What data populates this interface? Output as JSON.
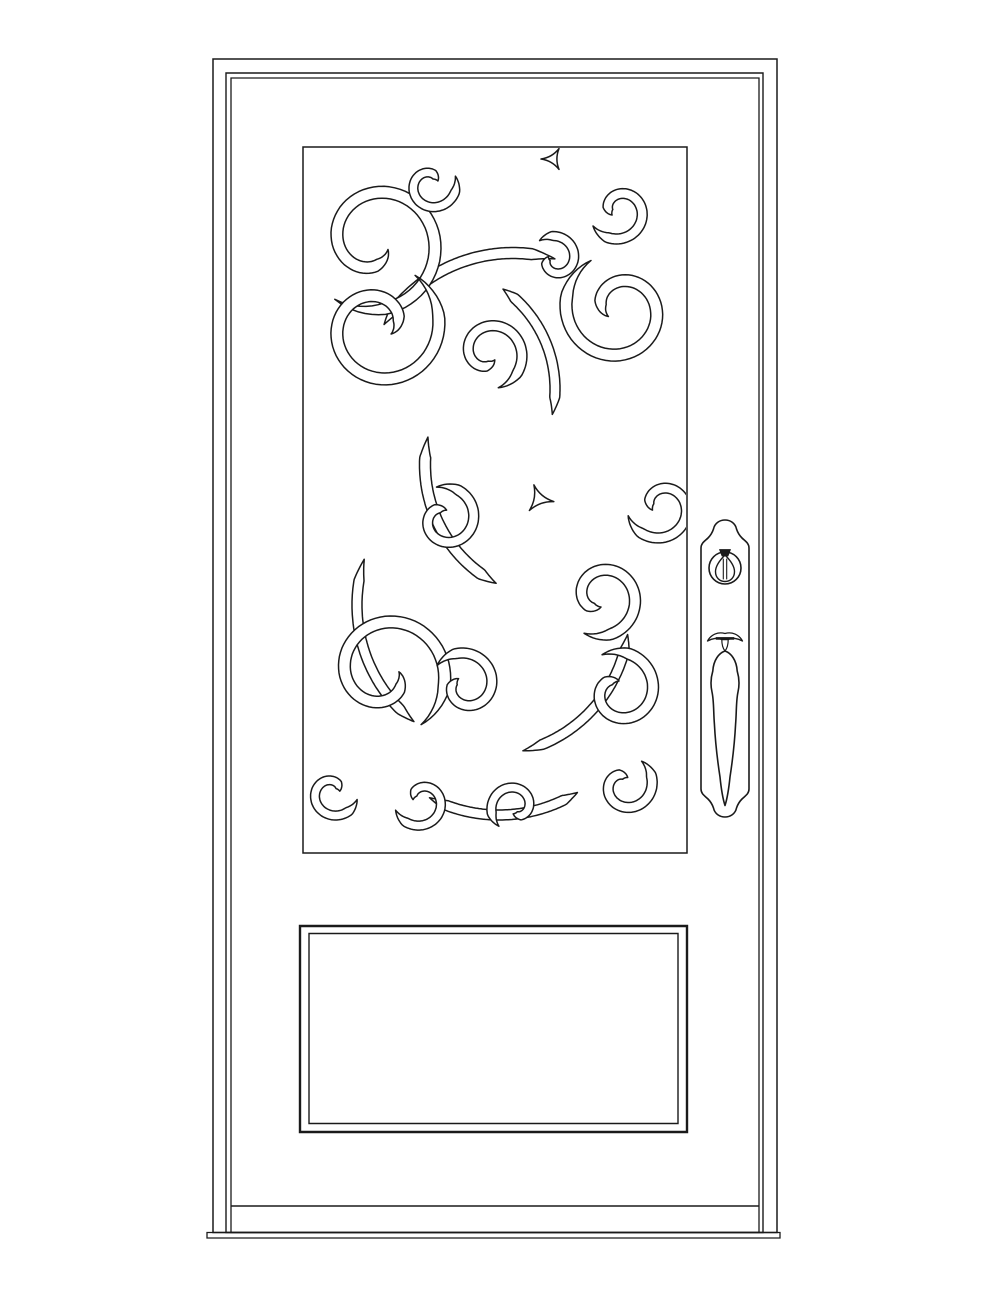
{
  "document": {
    "type": "door-elevation-line-drawing",
    "background_color": "#ffffff",
    "line_color": "#1a1a1a",
    "canvas": {
      "width": 1000,
      "height": 1294
    }
  },
  "frame": {
    "outer": {
      "name": "frame-outer-edge",
      "x": 213,
      "y": 59,
      "w": 564,
      "h": 1173.5,
      "sw": 1.5
    },
    "slab_outer": {
      "name": "door-slab-outer-edge",
      "x": 226,
      "y": 73,
      "w": 537,
      "h": 1159.5,
      "sw": 1.4
    },
    "slab_inner": {
      "name": "door-slab-inner-edge",
      "x": 231,
      "y": 78,
      "w": 528,
      "h": 1154.5,
      "sw": 1.3
    },
    "bottom_rail": {
      "name": "bottom-rail-line",
      "x1": 231,
      "y1": 1206,
      "x2": 759,
      "y2": 1206,
      "sw": 1.6
    },
    "sill": {
      "name": "threshold-sill",
      "x": 207,
      "y": 1232.5,
      "w": 573,
      "h": 5.5,
      "sw": 1.3
    }
  },
  "glass_panel": {
    "name": "glass-panel-border",
    "x": 303,
    "y": 147,
    "w": 384,
    "h": 706,
    "sw": 1.5
  },
  "bottom_panel": {
    "outer": {
      "name": "bottom-panel-outer-molding",
      "x": 300,
      "y": 926,
      "w": 387,
      "h": 206,
      "sw": 2.4
    },
    "inner": {
      "name": "bottom-panel-inner-molding",
      "x": 309,
      "y": 933.5,
      "w": 369,
      "h": 190,
      "sw": 1.4
    }
  },
  "ornament": {
    "clip": {
      "x": 1,
      "y": 1,
      "w": 382,
      "h": 704
    },
    "stroke_width": 1.5,
    "spirals": [
      {
        "cx": 72,
        "cy": 95,
        "R": 70,
        "rt": 15,
        "a0": 125,
        "a1": -330,
        "w": 6
      },
      {
        "cx": 128,
        "cy": 38,
        "R": 26,
        "rt": 8,
        "a0": -20,
        "a1": 330,
        "w": 4.5
      },
      {
        "cx": 316,
        "cy": 64,
        "R": 30,
        "rt": 8,
        "a0": 150,
        "a1": -210,
        "w": 5
      },
      {
        "cx": 252,
        "cy": 112,
        "R": 24,
        "rt": 7,
        "a0": 230,
        "a1": 560,
        "w": 4.5
      },
      {
        "cx": 316,
        "cy": 162,
        "R": 56,
        "rt": 13,
        "a0": 240,
        "a1": -215,
        "w": 6
      },
      {
        "cx": 76,
        "cy": 180,
        "R": 63,
        "rt": 14,
        "a0": -55,
        "a1": 390,
        "w": 6
      },
      {
        "cx": 186,
        "cy": 206,
        "R": 36,
        "rt": 9,
        "a0": 75,
        "a1": -310,
        "w": 5
      },
      {
        "cx": 142,
        "cy": 372,
        "R": 33,
        "rt": 9,
        "a0": 255,
        "a1": 640,
        "w": 5
      },
      {
        "cx": 358,
        "cy": 360,
        "R": 34,
        "rt": 9,
        "a0": 165,
        "a1": -200,
        "w": 5
      },
      {
        "cx": 298,
        "cy": 450,
        "R": 40,
        "rt": 10,
        "a0": 115,
        "a1": -270,
        "w": 5.5
      },
      {
        "cx": 316,
        "cy": 544,
        "R": 40,
        "rt": 10,
        "a0": -115,
        "a1": 270,
        "w": 5.5
      },
      {
        "cx": 82,
        "cy": 526,
        "R": 63,
        "rt": 14,
        "a0": 55,
        "a1": -365,
        "w": 6
      },
      {
        "cx": 162,
        "cy": 538,
        "R": 34,
        "rt": 9,
        "a0": 215,
        "a1": 585,
        "w": 5
      },
      {
        "cx": 30,
        "cy": 646,
        "R": 25,
        "rt": 7,
        "a0": 15,
        "a1": 345,
        "w": 4.5
      },
      {
        "cx": 118,
        "cy": 654,
        "R": 27,
        "rt": 8,
        "a0": 160,
        "a1": -170,
        "w": 4.5
      },
      {
        "cx": 212,
        "cy": 660,
        "R": 25,
        "rt": 7,
        "a0": 130,
        "a1": 465,
        "w": 4.5
      },
      {
        "cx": 322,
        "cy": 638,
        "R": 29,
        "rt": 8,
        "a0": -55,
        "a1": 290,
        "w": 5
      }
    ],
    "crescents": [
      {
        "cx": 210,
        "cy": 258,
        "R": 152,
        "a0": 212,
        "a1": 286,
        "w": 5.5
      },
      {
        "cx": 130,
        "cy": 242,
        "R": 122,
        "a0": 305,
        "a1": 372,
        "w": 5
      },
      {
        "cx": 256,
        "cy": 318,
        "R": 134,
        "a0": 118,
        "a1": 192,
        "w": 5.5
      },
      {
        "cx": 186,
        "cy": 468,
        "R": 140,
        "a0": 8,
        "a1": 76,
        "w": 5
      },
      {
        "cx": 202,
        "cy": 458,
        "R": 148,
        "a0": 128,
        "a1": 198,
        "w": 5
      },
      {
        "cx": 196,
        "cy": 520,
        "R": 148,
        "a0": 58,
        "a1": 118,
        "w": 5
      }
    ],
    "triangles": [
      {
        "cx": 236,
        "cy": 352,
        "r": 15,
        "rot": 10
      },
      {
        "cx": 250,
        "cy": 12,
        "r": 12,
        "rot": 180
      }
    ]
  },
  "handle": {
    "paths": [
      {
        "name": "escutcheon-plate",
        "fill": "#ffffff",
        "sw": 1.6,
        "d": "M701,789 L701,548 C701,543 705,541 708,538 C711,535 712.5,532 713.5,529 C716,517 734,517 736.5,529 C737.5,532 739,535 742,538 C745,541 749,543 749,548 L749,789 C749,794 745,796 742,799 C739,802 737.5,805 736.5,808 C734,820 716,820 713.5,808 C712.5,805 711,802 708,799 C705,796 701,794 701,789 Z"
      },
      {
        "name": "lockset-cylinder",
        "fill": "#ffffff",
        "sw": 1.6,
        "d": "M709,568 a16,16 0 1 0 32,0 a16,16 0 1 0 -32,0 Z"
      },
      {
        "name": "keyhole-icon",
        "fill": "none",
        "sw": 1.4,
        "d": "M725,555 C719,561 715.5,566 715.5,571.5 C715.5,577.5 719.5,581.5 725,581.5 C730.5,581.5 734.5,577.5 734.5,571.5 C734.5,566 731,561 725,555 Z"
      },
      {
        "name": "keyway-slot-left",
        "fill": "none",
        "sw": 1.1,
        "d": "M723.3,559 L723.3,579"
      },
      {
        "name": "keyway-slot-right",
        "fill": "none",
        "sw": 1.1,
        "d": "M726.7,559 L726.7,579"
      },
      {
        "name": "key-head",
        "fill": "#1a1a1a",
        "sw": 0.8,
        "d": "M719.5,549.5 L730.5,549.5 L728,556 L722,556 Z"
      },
      {
        "name": "thumb-latch-wings",
        "fill": "#ffffff",
        "sw": 1.3,
        "d": "M707.5,641 C711,634.5 718,631.5 725,633.5 C732,631.5 739,634.5 742.5,641 C737.5,638.2 732,637.4 728.2,639.6 L721.8,639.6 C718,637.4 712.5,638.2 707.5,641 Z"
      },
      {
        "name": "thumb-latch-bar",
        "fill": "#1a1a1a",
        "sw": 0.6,
        "d": "M716,637.4 L734,637.4 L734,639.4 L716,639.4 Z"
      },
      {
        "name": "thumb-latch-drop",
        "fill": "#ffffff",
        "sw": 1.2,
        "d": "M721.8,639.6 C721.8,645 723,648.5 725,651 C727,648.5 728.2,645 728.2,639.6 Z"
      },
      {
        "name": "pull-handle",
        "fill": "#ffffff",
        "sw": 1.6,
        "d": "M725,651 C719,653 713.5,660 712.8,671 C711,677 710.2,684 712,692 C714,701 713.4,712 714.4,724 C715.5,745 718,764 720,777 C721,787 722.3,797 725,805.5 C727.7,797 729,787 730,777 C732,764 734.5,745 735.6,724 C736.6,712 736,701 738,692 C739.8,684 739,677 737.2,671 C736.5,660 731,653 725,651 Z"
      }
    ]
  }
}
